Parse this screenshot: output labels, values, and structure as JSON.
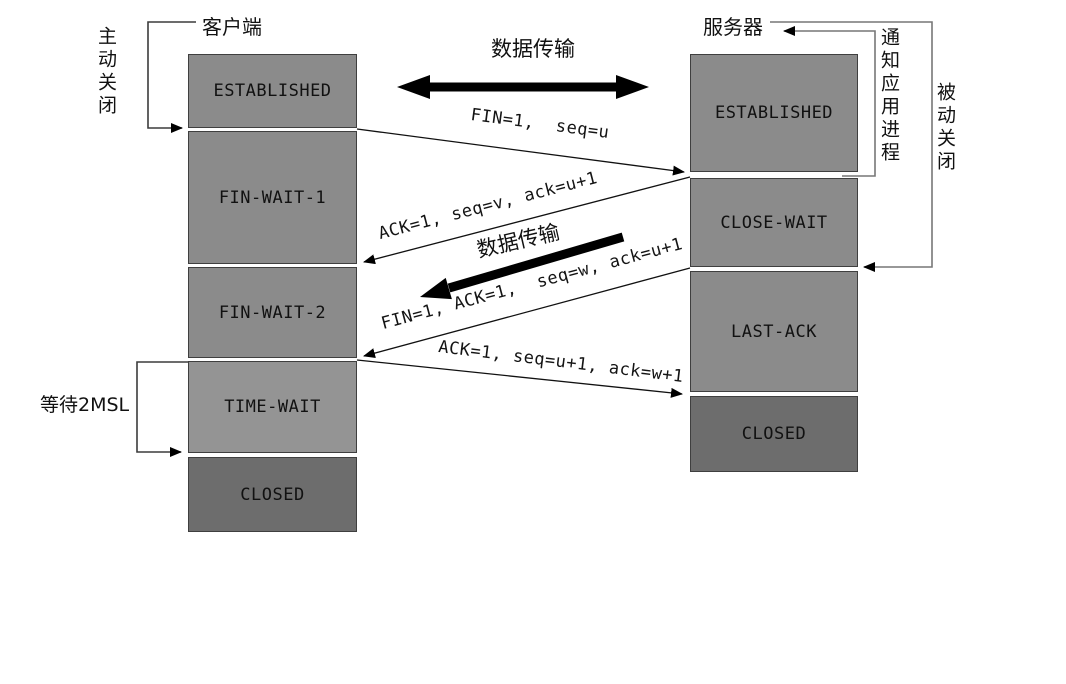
{
  "diagram": {
    "client": {
      "label": "客户端",
      "side_note": "主动关闭",
      "wait_note": "等待2MSL",
      "states": [
        {
          "label": "ESTABLISHED"
        },
        {
          "label": "FIN-WAIT-1"
        },
        {
          "label": "FIN-WAIT-2"
        },
        {
          "label": "TIME-WAIT"
        },
        {
          "label": "CLOSED"
        }
      ]
    },
    "server": {
      "label": "服务器",
      "notify_note": "通知应用进程",
      "side_note": "被动关闭",
      "states": [
        {
          "label": "ESTABLISHED"
        },
        {
          "label": "CLOSE-WAIT"
        },
        {
          "label": "LAST-ACK"
        },
        {
          "label": "CLOSED"
        }
      ]
    },
    "data_transfer": {
      "top_label": "数据传输",
      "mid_label": "数据传输"
    },
    "messages": [
      {
        "text": "FIN=1,  seq=u"
      },
      {
        "text": "ACK=1, seq=v, ack=u+1"
      },
      {
        "text": "FIN=1, ACK=1,  seq=w, ack=u+1"
      },
      {
        "text": "ACK=1, seq=u+1, ack=w+1"
      }
    ],
    "colors": {
      "state_fill": "#8b8b8b",
      "time_wait_fill": "#949494",
      "closed_fill": "#6d6d6d",
      "bracket_line": "#3c3c3c",
      "connector_line": "#777777",
      "message_line": "#111111",
      "thick_arrow": "#000000",
      "text": "#111111",
      "background": "#ffffff"
    }
  }
}
